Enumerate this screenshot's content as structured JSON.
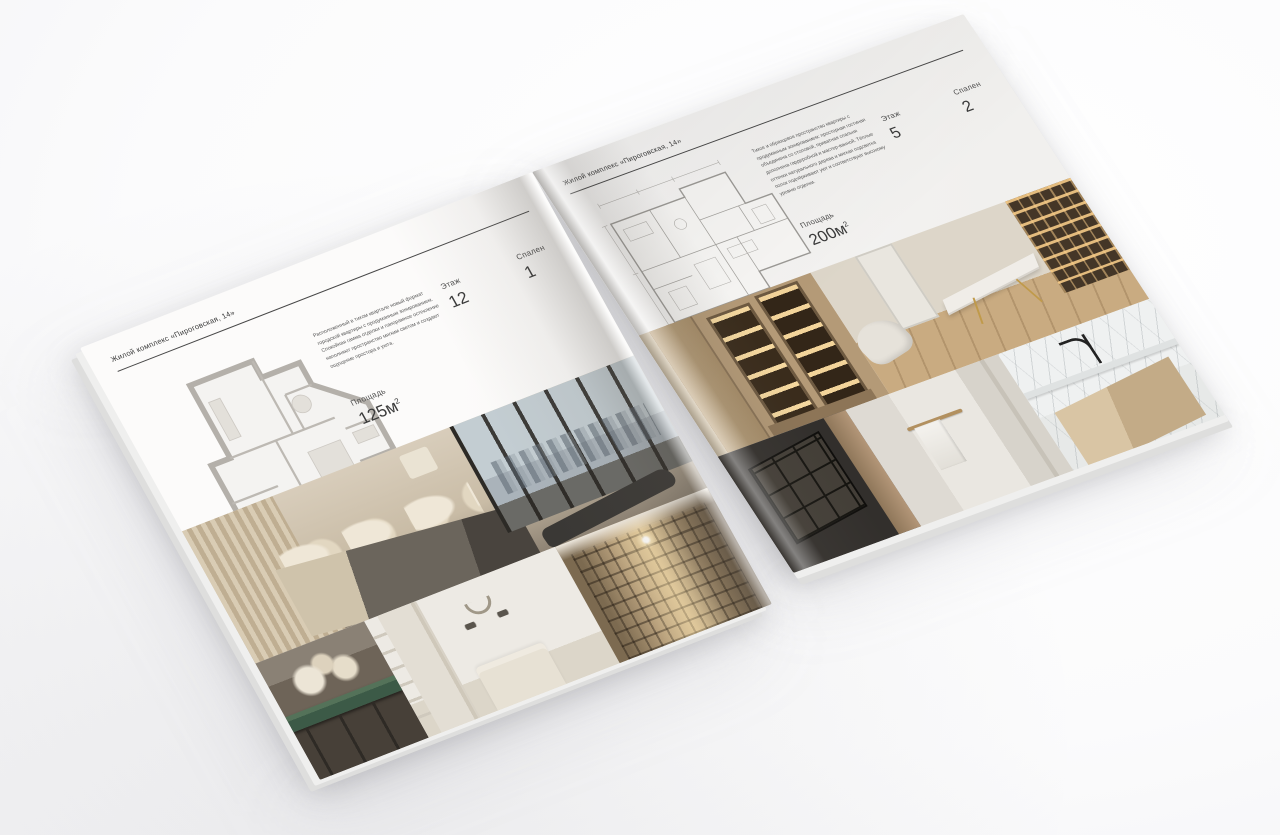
{
  "scene": {
    "background": "#fdfdfd"
  },
  "magazine": {
    "left_page": {
      "header": "Жилой комплекс «Пироговская, 14»",
      "description": "Расположенный в тихом квартале новый формат городской квартиры с продуманным зонированием. Спокойная гамма отделки и панорамное остекление наполняют пространство мягким светом и создают ощущение простора и уюта.",
      "specs": {
        "area_label": "Площадь",
        "area_value": "125м",
        "area_sup": "2",
        "floor_label": "Этаж",
        "floor_value": "12",
        "bedrooms_label": "Спален",
        "bedrooms_value": "1"
      },
      "photos": [
        "bedroom-panorama",
        "console-flowers",
        "bedroom-wreath",
        "library-corridor"
      ]
    },
    "right_page": {
      "header": "Жилой комплекс «Пироговская, 14»",
      "description": "Тихое и образцовое пространство квартиры с продуманным зонированием: просторная гостиная объединена со столовой, приватная спальня дополнена гардеробной и мастер-ванной. Тёплые оттенки натурального дерева и мягкая подсветка полок подчёркивают уют и соответствуют высокому уровню отделки.",
      "specs": {
        "area_label": "Площадь",
        "area_value": "200м",
        "area_sup": "2",
        "floor_label": "Этаж",
        "floor_value": "5",
        "bedrooms_label": "Спален",
        "bedrooms_value": "2"
      },
      "photos": [
        "backlit-cabinets",
        "study-room",
        "kitchen-detail",
        "bathroom-towel",
        "marble-washbasin"
      ]
    },
    "colors": {
      "page": "#faf9f8",
      "text": "#3a3a3a",
      "rule": "#474747",
      "plan_walls": "#b4b0aa",
      "plan_thin": "#9c9a96",
      "shadow": "#5f5f66"
    }
  }
}
